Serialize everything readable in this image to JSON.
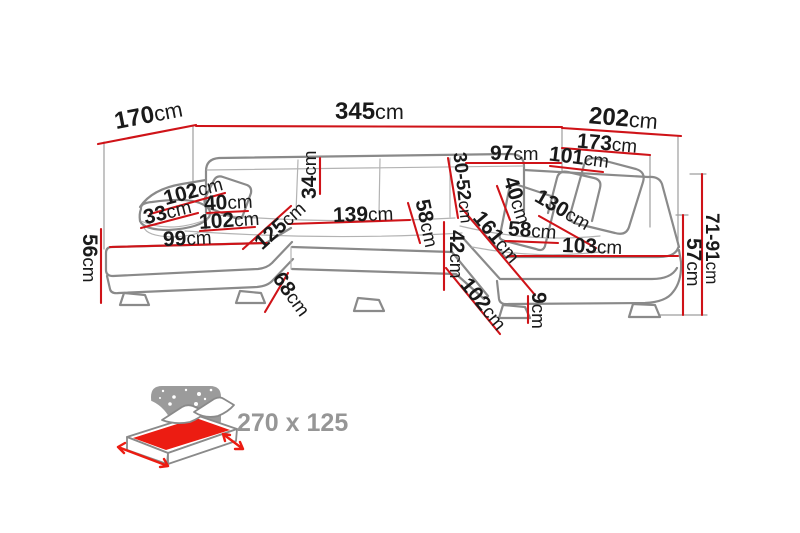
{
  "colors": {
    "dim_line": "#cf1318",
    "label_text": "#1a1a1a",
    "sofa_line": "#8a8a8a",
    "icon_gray": "#9b9b9b",
    "icon_red": "#ec1c12",
    "icon_text": "#969696"
  },
  "dims": {
    "left_depth": {
      "num": "170",
      "unit": "cm"
    },
    "total_width": {
      "num": "345",
      "unit": "cm"
    },
    "right_depth": {
      "num": "202",
      "unit": "cm"
    },
    "right_back_width": {
      "num": "173",
      "unit": "cm"
    },
    "right_top_width": {
      "num": "97",
      "unit": "cm"
    },
    "right_inner_width": {
      "num": "101",
      "unit": "cm"
    },
    "headrest_range": {
      "num": "30-52",
      "unit": "cm"
    },
    "back_cushion": {
      "num": "34",
      "unit": "cm"
    },
    "armrest_diagonal": {
      "num": "102",
      "unit": "cm"
    },
    "armrest": {
      "num": "33",
      "unit": "cm"
    },
    "pillow_left": {
      "num": "40",
      "unit": "cm"
    },
    "chaise_inner": {
      "num": "102",
      "unit": "cm"
    },
    "chaise_front": {
      "num": "99",
      "unit": "cm"
    },
    "height_left": {
      "num": "56",
      "unit": "cm"
    },
    "chaise_diagonal": {
      "num": "125",
      "unit": "cm"
    },
    "center_width": {
      "num": "139",
      "unit": "cm"
    },
    "center_depth": {
      "num": "58",
      "unit": "cm"
    },
    "front_height": {
      "num": "42",
      "unit": "cm"
    },
    "inner_diagonal": {
      "num": "161",
      "unit": "cm"
    },
    "pillow_right": {
      "num": "40",
      "unit": "cm"
    },
    "right_diagonal": {
      "num": "130",
      "unit": "cm"
    },
    "right_seat_depth": {
      "num": "58",
      "unit": "cm"
    },
    "right_chaise_width": {
      "num": "103",
      "unit": "cm"
    },
    "height_right": {
      "num": "57",
      "unit": "cm"
    },
    "back_height_range": {
      "num": "71-91",
      "unit": "cm"
    },
    "chaise_side": {
      "num": "68",
      "unit": "cm"
    },
    "front_diagonal": {
      "num": "102",
      "unit": "cm"
    },
    "leg_height": {
      "num": "9",
      "unit": "cm"
    }
  },
  "sleeping_area": {
    "label": "270 x 125"
  }
}
